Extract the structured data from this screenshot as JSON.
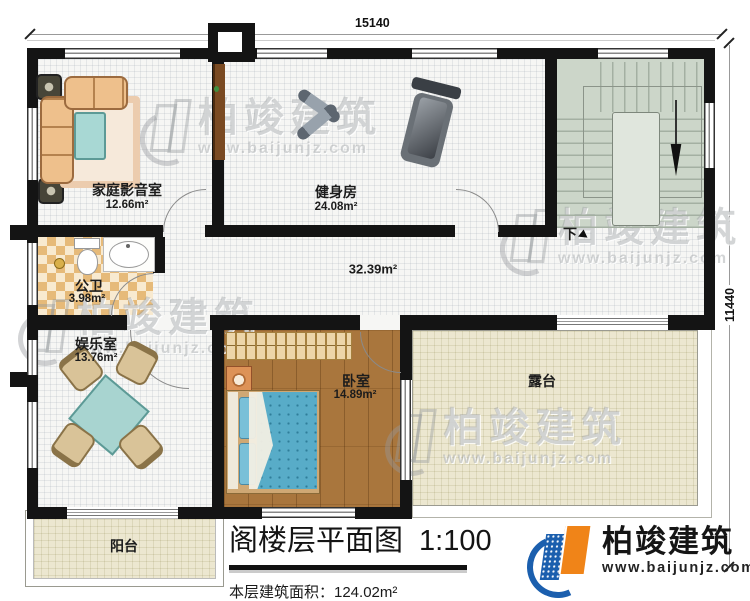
{
  "dimensions": {
    "top": "15140",
    "right": "11440"
  },
  "rooms": {
    "home_theater": {
      "name": "家庭影音室",
      "area": "12.66m²"
    },
    "gym": {
      "name": "健身房",
      "area": "24.08m²"
    },
    "public_bath": {
      "name": "公卫",
      "area": "3.98m²"
    },
    "hallway": {
      "area": "32.39m²"
    },
    "entertainment": {
      "name": "娱乐室",
      "area": "13.76m²"
    },
    "bedroom": {
      "name": "卧室",
      "area": "14.89m²"
    },
    "terrace": {
      "name": "露台"
    },
    "balcony": {
      "name": "阳台"
    }
  },
  "stairs": {
    "down_label": "下"
  },
  "title_block": {
    "title": "阁楼层平面图",
    "scale": "1:100",
    "area_text": "本层建筑面积：124.02m²"
  },
  "branding": {
    "company": "柏竣建筑",
    "website": "www.baijunjz.com"
  },
  "watermark": {
    "company": "柏竣建筑",
    "website": "www.baijunjz.com"
  }
}
